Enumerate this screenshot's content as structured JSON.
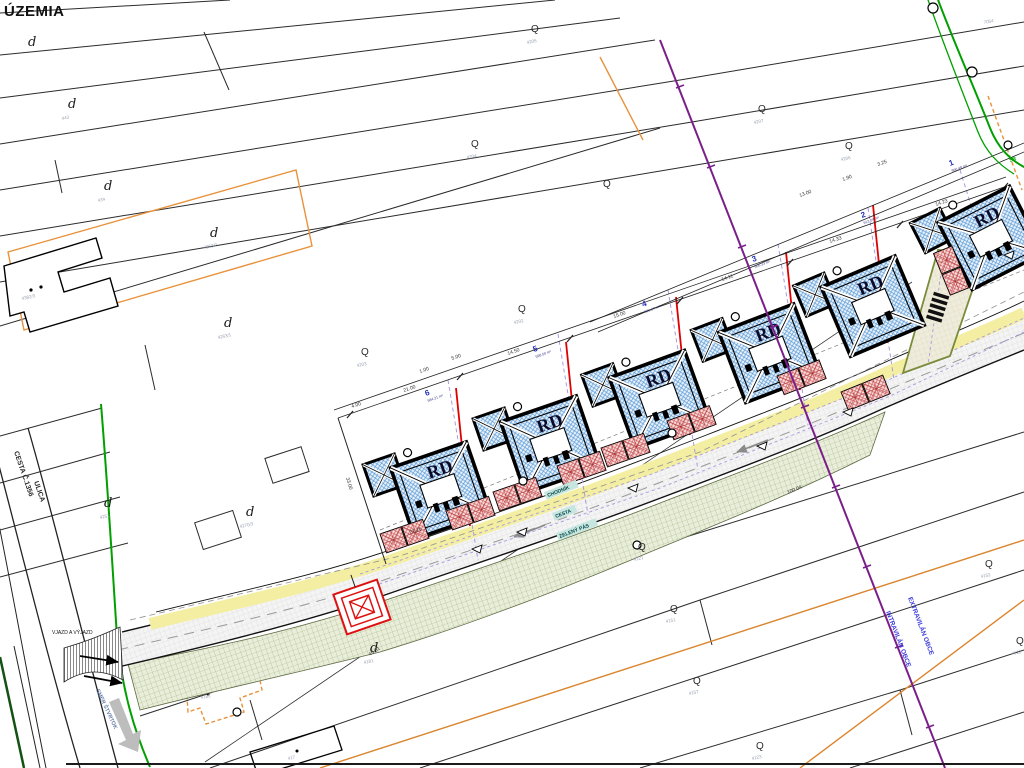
{
  "title": "ÚZEMIA",
  "map": {
    "existing_road_name": "CESTA Č.1356",
    "existing_road_name2": "ULICA",
    "direction_sign": "SMER ŠTVRTOK",
    "entrance_label": "VJAZD A VÝJAZD",
    "sidewalk_label": "CHODNÍK",
    "road_label": "CESTA",
    "green_belt_label": "ZELENÝ PÁS",
    "boundary_outside": "EXTRAVILÁN OBCE",
    "boundary_inside": "INTRAVILÁN OBCE",
    "utility_label": "SR"
  },
  "houses": [
    {
      "label": "RD"
    },
    {
      "label": "RD"
    },
    {
      "label": "RD"
    },
    {
      "label": "RD"
    },
    {
      "label": "RD"
    },
    {
      "label": "RD"
    }
  ],
  "plots": [
    {
      "no": "1",
      "area": "966.49 m²",
      "x": 950,
      "y": 166,
      "rot": -20
    },
    {
      "no": "2",
      "area": "612.04 m²",
      "x": 862,
      "y": 218,
      "rot": -20
    },
    {
      "no": "3",
      "area": "608.33 m²",
      "x": 753,
      "y": 262,
      "rot": -20
    },
    {
      "no": "4",
      "area": "601.27 m²",
      "x": 643,
      "y": 307,
      "rot": -20
    },
    {
      "no": "5",
      "area": "598.50 m²",
      "x": 534,
      "y": 352,
      "rot": -20
    },
    {
      "no": "6",
      "area": "584.21 m²",
      "x": 426,
      "y": 396,
      "rot": -20
    }
  ],
  "dimensions": [
    {
      "t": "21.00",
      "x": 404,
      "y": 392,
      "r": -19
    },
    {
      "t": "14.50",
      "x": 508,
      "y": 355,
      "r": -19
    },
    {
      "t": "15.00",
      "x": 614,
      "y": 318,
      "r": -19
    },
    {
      "t": "14.11",
      "x": 722,
      "y": 281,
      "r": -19
    },
    {
      "t": "14.33",
      "x": 830,
      "y": 243,
      "r": -19
    },
    {
      "t": "14.23",
      "x": 936,
      "y": 206,
      "r": -19
    },
    {
      "t": "5.00",
      "x": 452,
      "y": 360,
      "r": -19
    },
    {
      "t": "1.00",
      "x": 420,
      "y": 373,
      "r": -19
    },
    {
      "t": "4.00",
      "x": 352,
      "y": 408,
      "r": -19
    },
    {
      "t": "3.25",
      "x": 878,
      "y": 166,
      "r": -20
    },
    {
      "t": "1.90",
      "x": 843,
      "y": 181,
      "r": -20
    },
    {
      "t": "13.00",
      "x": 800,
      "y": 197,
      "r": -20
    },
    {
      "t": "33.00",
      "x": 346,
      "y": 478,
      "r": 73
    },
    {
      "t": "22.16",
      "x": 410,
      "y": 534,
      "r": -19
    },
    {
      "t": "100.04",
      "x": 788,
      "y": 494,
      "r": -23
    },
    {
      "t": "45.61",
      "x": 370,
      "y": 656,
      "r": -34
    }
  ],
  "parcel_symbols": {
    "d": {
      "glyph": "d",
      "positions": [
        [
          28,
          46
        ],
        [
          68,
          108
        ],
        [
          104,
          190
        ],
        [
          210,
          237
        ],
        [
          224,
          327
        ],
        [
          104,
          507
        ],
        [
          246,
          516
        ],
        [
          370,
          652
        ]
      ]
    },
    "q": {
      "glyph": "Q",
      "positions": [
        [
          531,
          32
        ],
        [
          471,
          147
        ],
        [
          603,
          187
        ],
        [
          758,
          112
        ],
        [
          845,
          149
        ],
        [
          361,
          355
        ],
        [
          518,
          312
        ],
        [
          638,
          550
        ],
        [
          670,
          612
        ],
        [
          693,
          684
        ],
        [
          756,
          749
        ],
        [
          985,
          567
        ],
        [
          1016,
          644
        ]
      ]
    }
  },
  "parcel_numbers": [
    {
      "t": "443",
      "x": 62,
      "y": 120
    },
    {
      "t": "434",
      "x": 98,
      "y": 202
    },
    {
      "t": "4263/2",
      "x": 204,
      "y": 249
    },
    {
      "t": "4263/1",
      "x": 218,
      "y": 339
    },
    {
      "t": "4251",
      "x": 100,
      "y": 519
    },
    {
      "t": "4270/3",
      "x": 240,
      "y": 528
    },
    {
      "t": "4203",
      "x": 357,
      "y": 367
    },
    {
      "t": "4205",
      "x": 527,
      "y": 44
    },
    {
      "t": "4204",
      "x": 467,
      "y": 159
    },
    {
      "t": "4207",
      "x": 754,
      "y": 124
    },
    {
      "t": "4206",
      "x": 841,
      "y": 161
    },
    {
      "t": "4202",
      "x": 514,
      "y": 324
    },
    {
      "t": "4181",
      "x": 364,
      "y": 664
    },
    {
      "t": "4382/3",
      "x": 22,
      "y": 300
    },
    {
      "t": "7054",
      "x": 984,
      "y": 24
    },
    {
      "t": "4121",
      "x": 634,
      "y": 561
    },
    {
      "t": "4151",
      "x": 666,
      "y": 623
    },
    {
      "t": "4157",
      "x": 689,
      "y": 695
    },
    {
      "t": "4152",
      "x": 981,
      "y": 578
    },
    {
      "t": "4122",
      "x": 1012,
      "y": 655
    },
    {
      "t": "4123",
      "x": 752,
      "y": 760
    },
    {
      "t": "4182",
      "x": 201,
      "y": 699
    },
    {
      "t": "417",
      "x": 288,
      "y": 760
    }
  ],
  "colors": {
    "roof_hatch": "#5b9bd5",
    "parking_hatch": "#cf5f5f",
    "green_belt": "#a4b283",
    "sidewalk": "#f3eea2",
    "boundary_purple": "#7a1f8a",
    "utility_green": "#00a000",
    "site_orange": "#e8923a",
    "building_line_red": "#e00000",
    "plot_line_lavender": "#a89ae0"
  }
}
